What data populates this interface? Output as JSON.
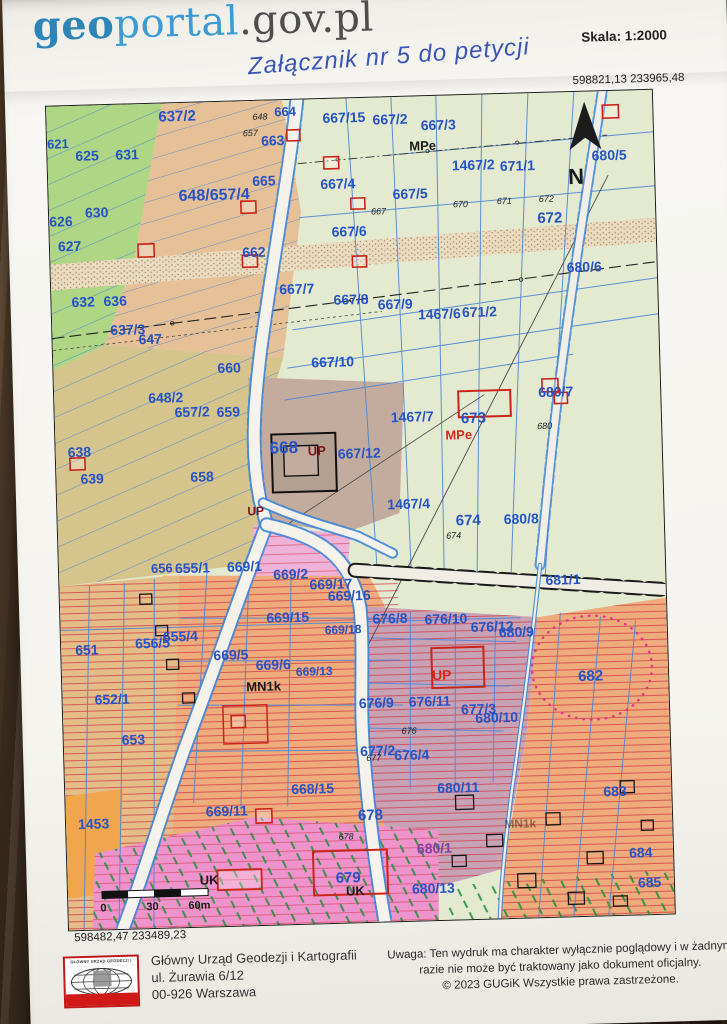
{
  "header": {
    "logo_geo": "geo",
    "logo_portal": "portal",
    "logo_suffix": ".gov.pl",
    "scale_label": "Skala:  1:2000"
  },
  "annotation": {
    "text": "Załącznik nr 5 do petycji"
  },
  "map": {
    "corner_coords_top_right": "598821,13  233965,48",
    "corner_coords_bottom_left": "598482,47  233489,23",
    "colors": {
      "label_blue": "#2653c6",
      "building_red": "#cc2418",
      "zone_dark_red": "#7a1616",
      "pale_green": "#e3ead0",
      "strip_green": "#aed684",
      "field_tan": "#e6c197",
      "field_olive": "#d6c48d",
      "orange_hatch": "#eeab7b",
      "mauve": "#c3ac9d",
      "purple_zone": "#c6a4b6",
      "uk_pink": "#ef93cc",
      "dotted_ellipse_pink": "#e8308e"
    },
    "parcel_labels": [
      {
        "t": "621",
        "x": 0,
        "y": 42,
        "s": 13
      },
      {
        "t": "625",
        "x": 28,
        "y": 55
      },
      {
        "t": "631",
        "x": 68,
        "y": 55
      },
      {
        "t": "637/2",
        "x": 112,
        "y": 18,
        "s": 15
      },
      {
        "t": "664",
        "x": 228,
        "y": 16,
        "s": 13
      },
      {
        "t": "663",
        "x": 214,
        "y": 45
      },
      {
        "t": "665",
        "x": 204,
        "y": 85
      },
      {
        "t": "648/657/4",
        "x": 130,
        "y": 98,
        "s": 16
      },
      {
        "t": "667/4",
        "x": 272,
        "y": 90
      },
      {
        "t": "667/15",
        "x": 276,
        "y": 24
      },
      {
        "t": "667/2",
        "x": 326,
        "y": 27
      },
      {
        "t": "667/3",
        "x": 374,
        "y": 34
      },
      {
        "t": "MPe",
        "x": 362,
        "y": 54,
        "s": 13,
        "c": "k"
      },
      {
        "t": "1467/2",
        "x": 404,
        "y": 75
      },
      {
        "t": "671/1",
        "x": 452,
        "y": 77
      },
      {
        "t": "680/5",
        "x": 544,
        "y": 69
      },
      {
        "t": "667/5",
        "x": 344,
        "y": 102
      },
      {
        "t": "672",
        "x": 488,
        "y": 130,
        "s": 15
      },
      {
        "t": "630",
        "x": 36,
        "y": 112
      },
      {
        "t": "626",
        "x": 0,
        "y": 120
      },
      {
        "t": "627",
        "x": 8,
        "y": 145
      },
      {
        "t": "662",
        "x": 192,
        "y": 156
      },
      {
        "t": "667/6",
        "x": 282,
        "y": 138
      },
      {
        "t": "680/6",
        "x": 516,
        "y": 180
      },
      {
        "t": "632",
        "x": 20,
        "y": 201
      },
      {
        "t": "636",
        "x": 52,
        "y": 201
      },
      {
        "t": "667/7",
        "x": 228,
        "y": 194
      },
      {
        "t": "667/8",
        "x": 282,
        "y": 206
      },
      {
        "t": "667/9",
        "x": 326,
        "y": 212
      },
      {
        "t": "1467/6",
        "x": 366,
        "y": 223
      },
      {
        "t": "671/2",
        "x": 410,
        "y": 222
      },
      {
        "t": "637/3",
        "x": 58,
        "y": 230
      },
      {
        "t": "647",
        "x": 86,
        "y": 240
      },
      {
        "t": "667/10",
        "x": 258,
        "y": 268
      },
      {
        "t": "648/2",
        "x": 94,
        "y": 299
      },
      {
        "t": "657/2",
        "x": 120,
        "y": 314
      },
      {
        "t": "659",
        "x": 162,
        "y": 315
      },
      {
        "t": "660",
        "x": 164,
        "y": 271
      },
      {
        "t": "638",
        "x": 12,
        "y": 351
      },
      {
        "t": "639",
        "x": 24,
        "y": 378
      },
      {
        "t": "658",
        "x": 134,
        "y": 379
      },
      {
        "t": "668",
        "x": 214,
        "y": 353,
        "s": 17
      },
      {
        "t": "UP",
        "x": 252,
        "y": 356,
        "s": 13,
        "c": "dr"
      },
      {
        "t": "667/12",
        "x": 282,
        "y": 360
      },
      {
        "t": "1467/7",
        "x": 336,
        "y": 325
      },
      {
        "t": "673",
        "x": 406,
        "y": 328,
        "s": 15
      },
      {
        "t": "MPe",
        "x": 390,
        "y": 344,
        "s": 13,
        "c": "r"
      },
      {
        "t": "680/7",
        "x": 484,
        "y": 304
      },
      {
        "t": "1467/4",
        "x": 330,
        "y": 412
      },
      {
        "t": "674",
        "x": 398,
        "y": 430,
        "s": 15
      },
      {
        "t": "680/8",
        "x": 446,
        "y": 430
      },
      {
        "t": "UP",
        "x": 190,
        "y": 414,
        "s": 12,
        "c": "dr"
      },
      {
        "t": "656",
        "x": 92,
        "y": 469,
        "s": 13
      },
      {
        "t": "655/1",
        "x": 116,
        "y": 470
      },
      {
        "t": "669/1",
        "x": 168,
        "y": 470
      },
      {
        "t": "669/2",
        "x": 214,
        "y": 479
      },
      {
        "t": "669/17",
        "x": 250,
        "y": 490
      },
      {
        "t": "669/16",
        "x": 268,
        "y": 502
      },
      {
        "t": "669/15",
        "x": 206,
        "y": 522
      },
      {
        "t": "669/18",
        "x": 264,
        "y": 535,
        "s": 12
      },
      {
        "t": "655/4",
        "x": 102,
        "y": 538
      },
      {
        "t": "656/5",
        "x": 74,
        "y": 544
      },
      {
        "t": "651",
        "x": 14,
        "y": 549
      },
      {
        "t": "669/5",
        "x": 152,
        "y": 558
      },
      {
        "t": "669/6",
        "x": 194,
        "y": 569
      },
      {
        "t": "669/13",
        "x": 234,
        "y": 576,
        "s": 12
      },
      {
        "t": "MN1k",
        "x": 184,
        "y": 590,
        "s": 13,
        "c": "k"
      },
      {
        "t": "652/1",
        "x": 32,
        "y": 599
      },
      {
        "t": "681/1",
        "x": 486,
        "y": 492
      },
      {
        "t": "676/8",
        "x": 312,
        "y": 526
      },
      {
        "t": "676/10",
        "x": 364,
        "y": 528
      },
      {
        "t": "676/12",
        "x": 410,
        "y": 537
      },
      {
        "t": "680/9",
        "x": 438,
        "y": 543
      },
      {
        "t": "UP",
        "x": 370,
        "y": 584,
        "s": 14,
        "c": "r"
      },
      {
        "t": "682",
        "x": 516,
        "y": 589,
        "s": 15
      },
      {
        "t": "676/9",
        "x": 296,
        "y": 610
      },
      {
        "t": "676/11",
        "x": 346,
        "y": 610
      },
      {
        "t": "677/3",
        "x": 398,
        "y": 619
      },
      {
        "t": "680/10",
        "x": 412,
        "y": 628
      },
      {
        "t": "677/2",
        "x": 296,
        "y": 658
      },
      {
        "t": "676/4",
        "x": 330,
        "y": 663
      },
      {
        "t": "653",
        "x": 58,
        "y": 640
      },
      {
        "t": "1453",
        "x": 12,
        "y": 723
      },
      {
        "t": "669/11",
        "x": 140,
        "y": 714
      },
      {
        "t": "668/15",
        "x": 226,
        "y": 694
      },
      {
        "t": "678",
        "x": 292,
        "y": 722,
        "s": 15
      },
      {
        "t": "680/11",
        "x": 372,
        "y": 697
      },
      {
        "t": "683",
        "x": 538,
        "y": 705
      },
      {
        "t": "680/1",
        "x": 350,
        "y": 757,
        "c": "p"
      },
      {
        "t": "680/13",
        "x": 344,
        "y": 797
      },
      {
        "t": "684",
        "x": 562,
        "y": 767
      },
      {
        "t": "685",
        "x": 570,
        "y": 797
      },
      {
        "t": "679",
        "x": 268,
        "y": 784,
        "s": 15
      },
      {
        "t": "UK",
        "x": 132,
        "y": 782,
        "s": 13,
        "c": "k"
      },
      {
        "t": "UK",
        "x": 278,
        "y": 797,
        "s": 13,
        "c": "k"
      },
      {
        "t": "MN1k",
        "x": 438,
        "y": 734,
        "s": 12,
        "c": "kf"
      },
      {
        "t": "N",
        "x": 520,
        "y": 92,
        "s": 22,
        "c": "k"
      },
      {
        "t": "648",
        "x": 206,
        "y": 19,
        "s": 9,
        "c": "i"
      },
      {
        "t": "657",
        "x": 196,
        "y": 35,
        "s": 9,
        "c": "i"
      },
      {
        "t": "667",
        "x": 322,
        "y": 117,
        "s": 9,
        "c": "i"
      },
      {
        "t": "670",
        "x": 404,
        "y": 112,
        "s": 9,
        "c": "i"
      },
      {
        "t": "671",
        "x": 448,
        "y": 110,
        "s": 9,
        "c": "i"
      },
      {
        "t": "672",
        "x": 490,
        "y": 109,
        "s": 9,
        "c": "i"
      },
      {
        "t": "680",
        "x": 482,
        "y": 336,
        "s": 9,
        "c": "i"
      },
      {
        "t": "674",
        "x": 388,
        "y": 443,
        "s": 9,
        "c": "i"
      },
      {
        "t": "676",
        "x": 338,
        "y": 637,
        "s": 9,
        "c": "i"
      },
      {
        "t": "677",
        "x": 302,
        "y": 663,
        "s": 9,
        "c": "i"
      },
      {
        "t": "678",
        "x": 272,
        "y": 741,
        "s": 9,
        "c": "i"
      },
      {
        "t": "0",
        "x": 32,
        "y": 806,
        "s": 11,
        "c": "k"
      },
      {
        "t": "30",
        "x": 78,
        "y": 806,
        "s": 11,
        "c": "k"
      },
      {
        "t": "60m",
        "x": 120,
        "y": 806,
        "s": 11,
        "c": "k"
      }
    ]
  },
  "footer": {
    "logo_caption": "GŁÓWNY URZĄD GEODEZJI I KARTOGRAFII",
    "org_name": "Główny Urząd Geodezji i Kartografii",
    "org_street": "ul. Żurawia 6/12",
    "org_city": "00-926 Warszawa",
    "note_line1": "Uwaga: Ten wydruk ma charakter wyłącznie poglądowy i w żadnym",
    "note_line2": "razie nie może być traktowany jako dokument oficjalny.",
    "note_line3": "© 2023 GUGiK Wszystkie prawa zastrzeżone."
  }
}
